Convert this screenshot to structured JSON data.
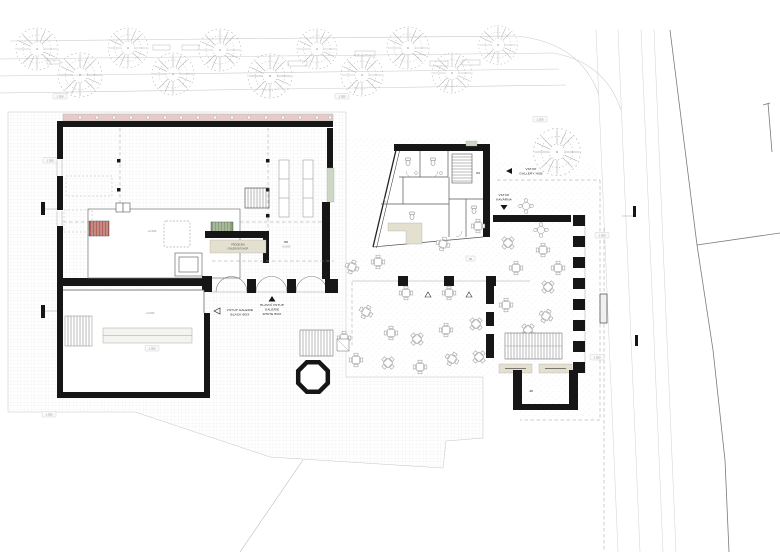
{
  "plan": {
    "title": "Ground floor site plan - gallery complex",
    "language": "cs",
    "entrances": {
      "black_box": {
        "l1": "VSTUP GALERIE",
        "l2": "BLACK BOX"
      },
      "white_box": {
        "l1": "HLAVNÍ VSTUP",
        "l2": "GALERIE",
        "l3": "WHITE BOX"
      },
      "gallery_hub": {
        "l1": "VSTUP",
        "l2": "GALLERY HUB"
      },
      "cafe": {
        "l1": "VSTUP",
        "l2": "KAVÁRNA"
      }
    },
    "rooms": {
      "shop_no": "03",
      "shop_name_l1": "PRODEJNA",
      "shop_name_l2": "GALERIJNÍ SHOP",
      "wc_no": "04",
      "terrace_no": "06",
      "cellar_no": "10"
    },
    "levels": {
      "zero": "+0,000",
      "street": "1.350"
    },
    "colors": {
      "wall": "#161616",
      "stair_red": "#b2645c",
      "stair_green": "#8aa07a",
      "facade_pink": "#e7cbc9",
      "glazing_green": "#ccd8c3",
      "mat_beige": "#e4e0cf"
    }
  }
}
